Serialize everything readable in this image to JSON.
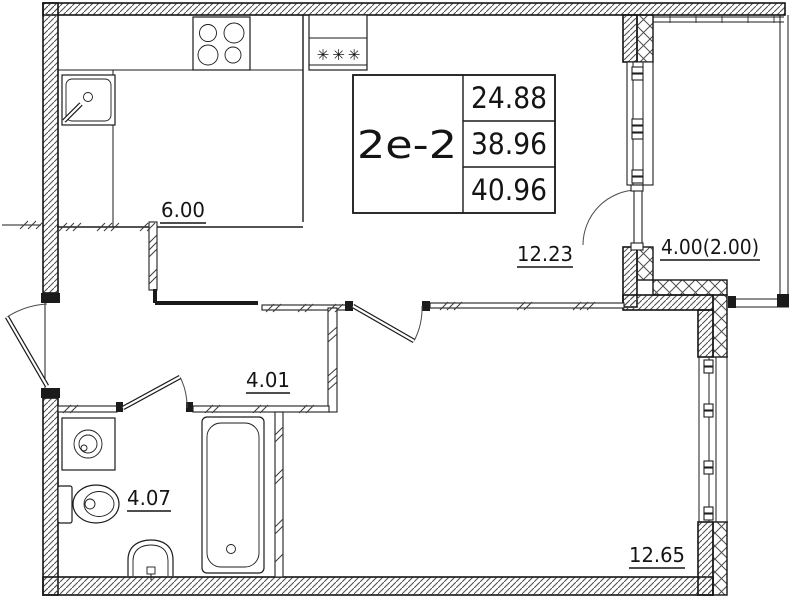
{
  "stamp": {
    "unit_type": "2е-2",
    "area_living": "24.88",
    "area_total": "38.96",
    "area_total_with_balcony": "40.96"
  },
  "rooms": {
    "kitchen": {
      "area": "6.00"
    },
    "living": {
      "area": "12.23"
    },
    "hallway": {
      "area": "4.01"
    },
    "bathroom": {
      "area": "4.07"
    },
    "bedroom": {
      "area": "12.65"
    },
    "balcony": {
      "area": "4.00(2.00)"
    }
  },
  "symbols": {
    "vent": "✳✳✳"
  }
}
